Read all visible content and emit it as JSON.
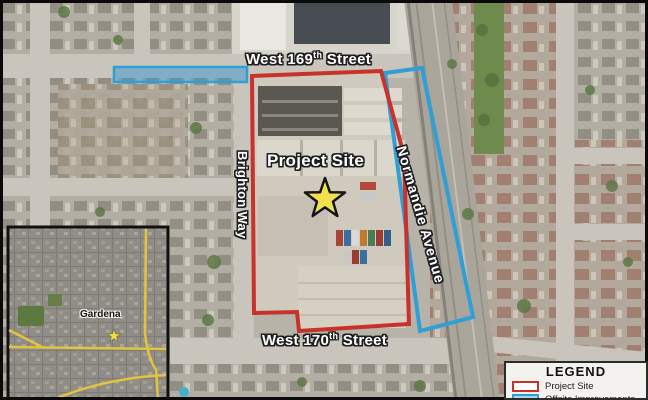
{
  "overlay": {
    "street_169": {
      "prefix": "West 169",
      "sup": "th",
      "suffix": " Street"
    },
    "street_170": {
      "prefix": "West 170",
      "sup": "th",
      "suffix": " Street"
    },
    "brighton_way": "Brighton Way",
    "normandie": "Normandie Avenue",
    "project_site": "Project Site"
  },
  "inset": {
    "city": "Gardena"
  },
  "legend": {
    "title": "LEGEND",
    "items": [
      {
        "label": "Project Site",
        "border": "#c9322b",
        "fill": "#ffffff"
      },
      {
        "label": "Offsite Improvements",
        "border": "#2f9fd6",
        "fill": "#a8d8ea"
      }
    ]
  },
  "colors": {
    "project_site_outline": "#c9322b",
    "offsite_outline": "#2f9fd6",
    "offsite_fill": "#3a98d0",
    "star_fill": "#f2e14c"
  }
}
